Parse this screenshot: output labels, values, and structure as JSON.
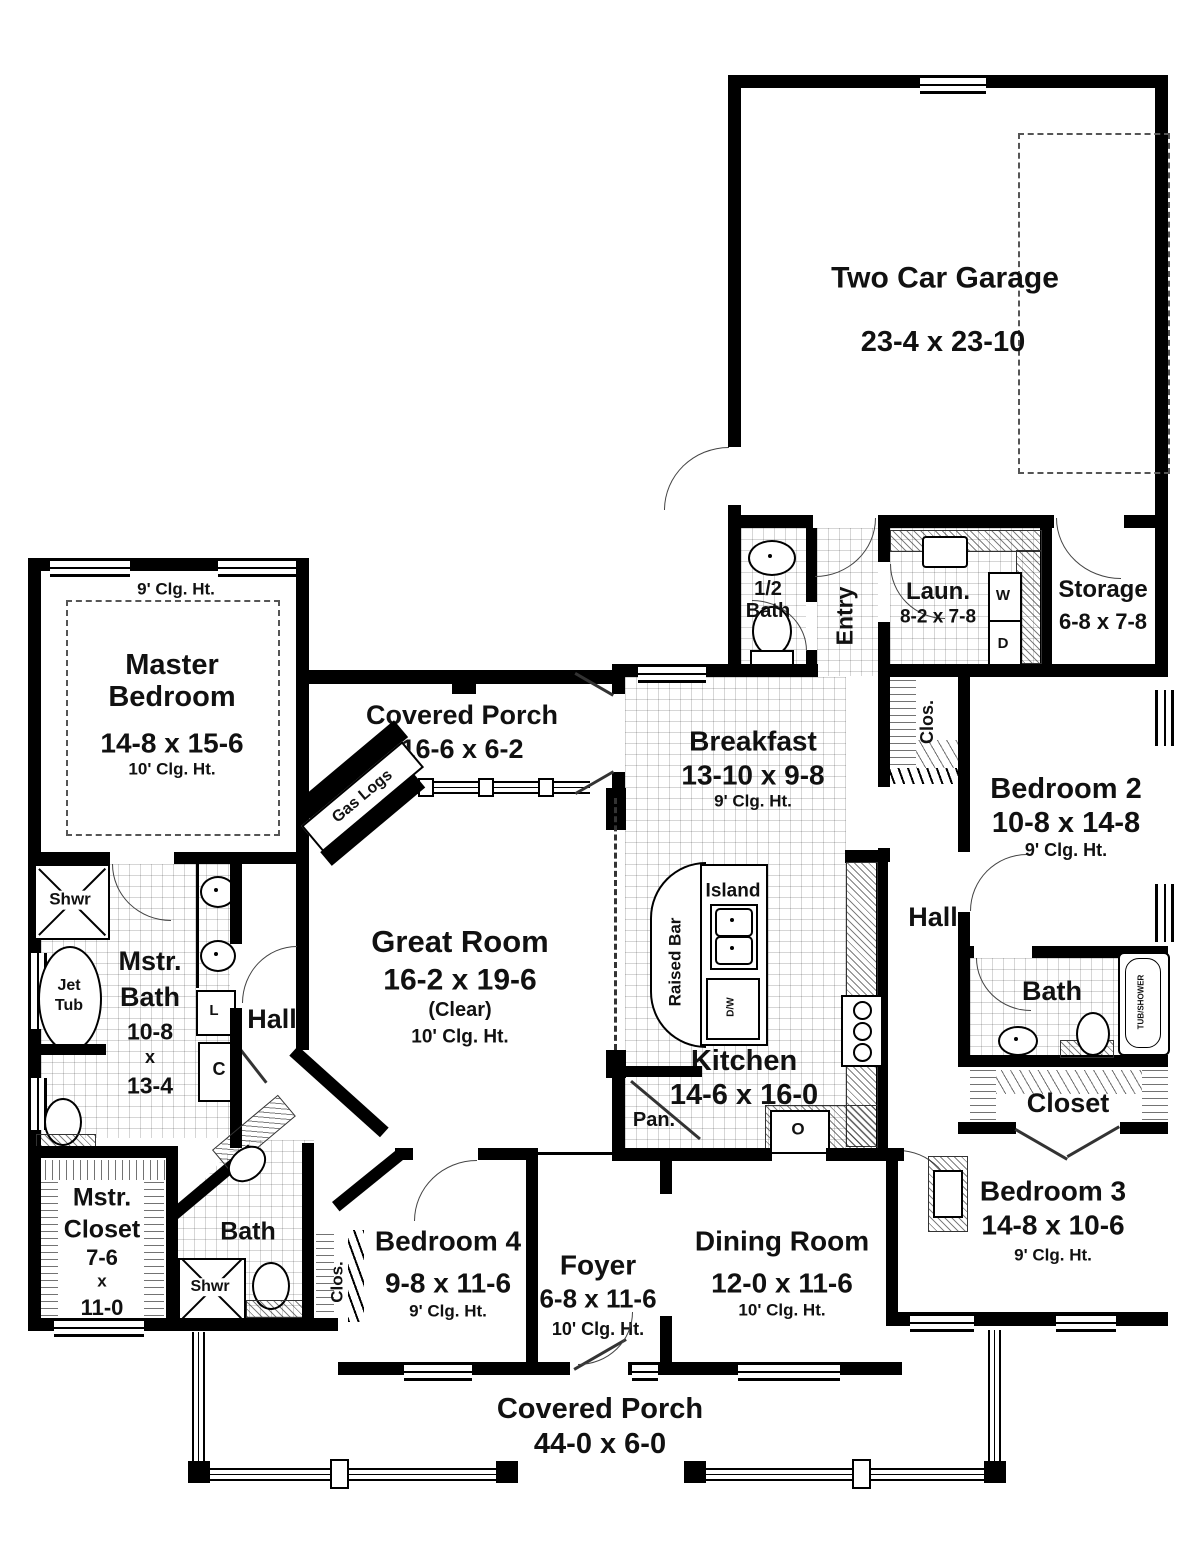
{
  "plan": {
    "garage": {
      "name": "Two Car Garage",
      "dims": "23-4 x 23-10"
    },
    "master_bedroom": {
      "wall_clg": "9' Clg. Ht.",
      "name": "Master Bedroom",
      "dims": "14-8 x 15-6",
      "clg": "10' Clg. Ht."
    },
    "covered_porch_rear": {
      "name": "Covered Porch",
      "dims": "16-6 x 6-2"
    },
    "breakfast": {
      "name": "Breakfast",
      "dims": "13-10 x 9-8",
      "clg": "9' Clg. Ht."
    },
    "half_bath": {
      "name": "1/2 Bath"
    },
    "entry": {
      "name": "Entry"
    },
    "laundry": {
      "name": "Laun.",
      "dims": "8-2 x 7-8"
    },
    "storage": {
      "name": "Storage",
      "dims": "6-8 x 7-8"
    },
    "bedroom2": {
      "name": "Bedroom 2",
      "dims": "10-8 x 14-8",
      "clg": "9' Clg. Ht."
    },
    "closet_bed2": {
      "name": "Clos."
    },
    "hall_right": {
      "name": "Hall"
    },
    "great_room": {
      "name": "Great Room",
      "dims": "16-2 x 19-6",
      "note": "(Clear)",
      "clg": "10' Clg. Ht."
    },
    "fireplace": {
      "name": "Gas Logs"
    },
    "kitchen": {
      "name": "Kitchen",
      "dims": "14-6 x 16-0"
    },
    "island": {
      "name": "Island"
    },
    "raised_bar": {
      "name": "Raised Bar"
    },
    "pantry": {
      "name": "Pan."
    },
    "master_bath": {
      "line1": "Mstr.",
      "line2": "Bath",
      "line3": "10-8",
      "line4": "x",
      "line5": "13-4"
    },
    "shower_master": {
      "name": "Shwr"
    },
    "jet_tub": {
      "line1": "Jet",
      "line2": "Tub"
    },
    "linen": {
      "name": "L"
    },
    "closet_c": {
      "name": "C"
    },
    "hall_left": {
      "name": "Hall"
    },
    "master_closet": {
      "line1": "Mstr.",
      "line2": "Closet",
      "line3": "7-6",
      "line4": "x",
      "line5": "11-0"
    },
    "bath_left": {
      "name": "Bath"
    },
    "shower_left": {
      "name": "Shwr"
    },
    "closet_bed4": {
      "name": "Clos."
    },
    "bedroom4": {
      "name": "Bedroom 4",
      "dims": "9-8 x 11-6",
      "clg": "9' Clg. Ht."
    },
    "foyer": {
      "name": "Foyer",
      "dims": "6-8 x 11-6",
      "clg": "10' Clg. Ht."
    },
    "dining": {
      "name": "Dining Room",
      "dims": "12-0 x 11-6",
      "clg": "10' Clg. Ht."
    },
    "bath_right": {
      "name": "Bath"
    },
    "tub_shower": {
      "name": "TUB/SHOWER"
    },
    "closet_bed3": {
      "name": "Closet"
    },
    "bedroom3": {
      "name": "Bedroom 3",
      "dims": "14-8 x 10-6",
      "clg": "9' Clg. Ht."
    },
    "covered_porch_front": {
      "name": "Covered Porch",
      "dims": "44-0 x 6-0"
    },
    "appliances": {
      "washer": "W",
      "dryer": "D",
      "oven": "O",
      "dishwasher": "D/W"
    },
    "colors": {
      "wall": "#000000",
      "text": "#111111"
    }
  }
}
